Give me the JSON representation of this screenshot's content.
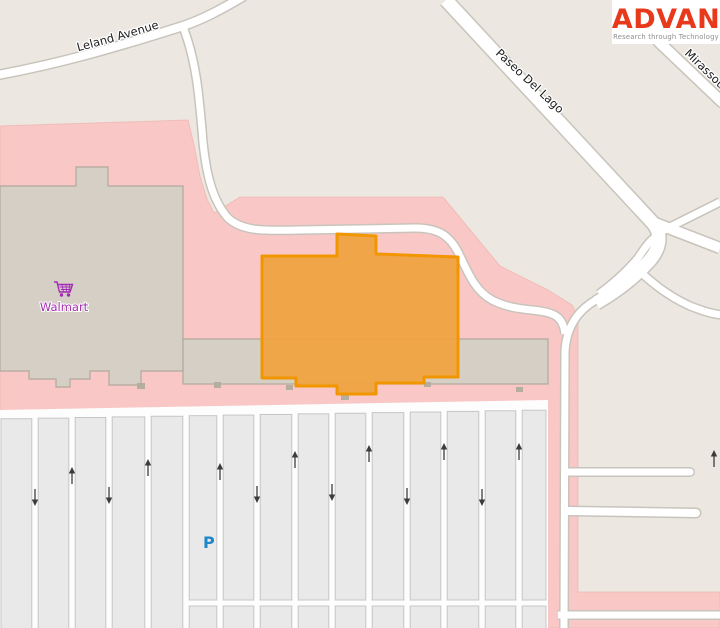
{
  "logo": {
    "brand": "ADVAN",
    "tagline": "Research through Technology",
    "brand_color": "#e8391a",
    "tagline_color": "#8d8d8d"
  },
  "map": {
    "road_labels": {
      "leland": "Leland Avenue",
      "paseo": "Paseo Del Lago",
      "mirassou": "Mirassou"
    },
    "poi": {
      "walmart": {
        "label": "Walmart",
        "icon": "shopping-cart-icon",
        "color": "#a62db0"
      }
    },
    "highlight": {
      "name": "highlighted building",
      "fill": "#efa342",
      "stroke": "#f29600"
    },
    "colors": {
      "land": "#ece8e1",
      "retail_area": "#f9c8c6",
      "retail_edge": "#edaca7",
      "road_fill": "#ffffff",
      "road_casing": "#c8c4bc",
      "building_fill": "#d5cfc6",
      "building_stroke": "#b1a99c",
      "parking_cell": "#e9e9e9",
      "parking_cell_border": "#c6c6c6",
      "arrow": "#3c3c3c",
      "parking_blue": "#1d87c9"
    },
    "parking": {
      "symbol": "P",
      "lane_x": [
        1,
        35,
        72,
        109,
        148,
        186,
        220,
        257,
        295,
        332,
        369,
        407,
        444,
        482,
        519,
        546
      ],
      "arrows": [
        {
          "x": 35,
          "y": 497,
          "dir": "down"
        },
        {
          "x": 72,
          "y": 476,
          "dir": "up"
        },
        {
          "x": 109,
          "y": 495,
          "dir": "down"
        },
        {
          "x": 148,
          "y": 468,
          "dir": "up"
        },
        {
          "x": 220,
          "y": 472,
          "dir": "up"
        },
        {
          "x": 257,
          "y": 494,
          "dir": "down"
        },
        {
          "x": 295,
          "y": 460,
          "dir": "up"
        },
        {
          "x": 332,
          "y": 492,
          "dir": "down"
        },
        {
          "x": 369,
          "y": 454,
          "dir": "up"
        },
        {
          "x": 407,
          "y": 496,
          "dir": "down"
        },
        {
          "x": 444,
          "y": 452,
          "dir": "up"
        },
        {
          "x": 482,
          "y": 497,
          "dir": "down"
        },
        {
          "x": 519,
          "y": 452,
          "dir": "up"
        },
        {
          "x": 714,
          "y": 459,
          "dir": "up"
        }
      ]
    }
  }
}
